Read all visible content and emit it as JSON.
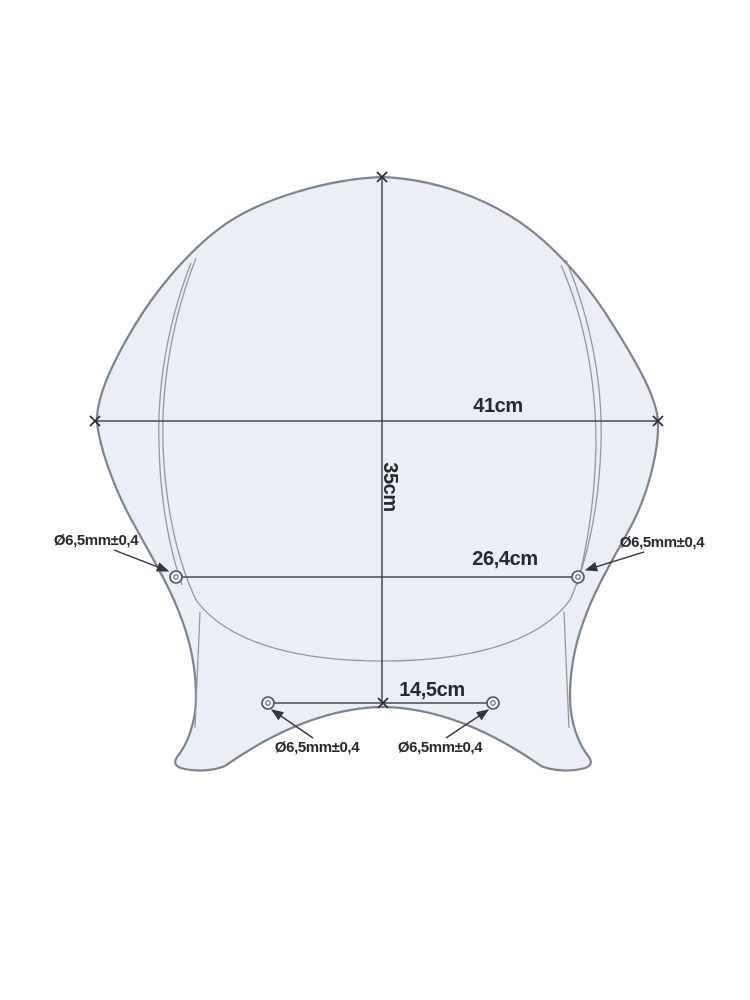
{
  "page": {
    "background": "#ffffff"
  },
  "diagram": {
    "type": "technical-drawing",
    "subject": "motorcycle windscreen template with mounting holes",
    "colors": {
      "screen_fill": "#eaeef5",
      "screen_outline": "#7c848e",
      "inner_line": "#9099a3",
      "dimension_line": "#44484e",
      "text": "#26292d"
    },
    "dimensions": [
      {
        "id": "overall_width",
        "label": "41cm",
        "value_cm": 41,
        "orientation": "horizontal"
      },
      {
        "id": "overall_height",
        "label": "35cm",
        "value_cm": 35,
        "orientation": "vertical"
      },
      {
        "id": "upper_hole_spacing",
        "label": "26,4cm",
        "value_cm": 26.4,
        "orientation": "horizontal"
      },
      {
        "id": "lower_hole_spacing",
        "label": "14,5cm",
        "value_cm": 14.5,
        "orientation": "horizontal"
      }
    ],
    "hole_labels": [
      {
        "id": "upper_left",
        "label": "Ø6,5mm±0,4",
        "diameter_mm": 6.5,
        "tolerance_mm": 0.4
      },
      {
        "id": "upper_right",
        "label": "Ø6,5mm±0,4",
        "diameter_mm": 6.5,
        "tolerance_mm": 0.4
      },
      {
        "id": "lower_left",
        "label": "Ø6,5mm±0,4",
        "diameter_mm": 6.5,
        "tolerance_mm": 0.4
      },
      {
        "id": "lower_right",
        "label": "Ø6,5mm±0,4",
        "diameter_mm": 6.5,
        "tolerance_mm": 0.4
      }
    ]
  }
}
